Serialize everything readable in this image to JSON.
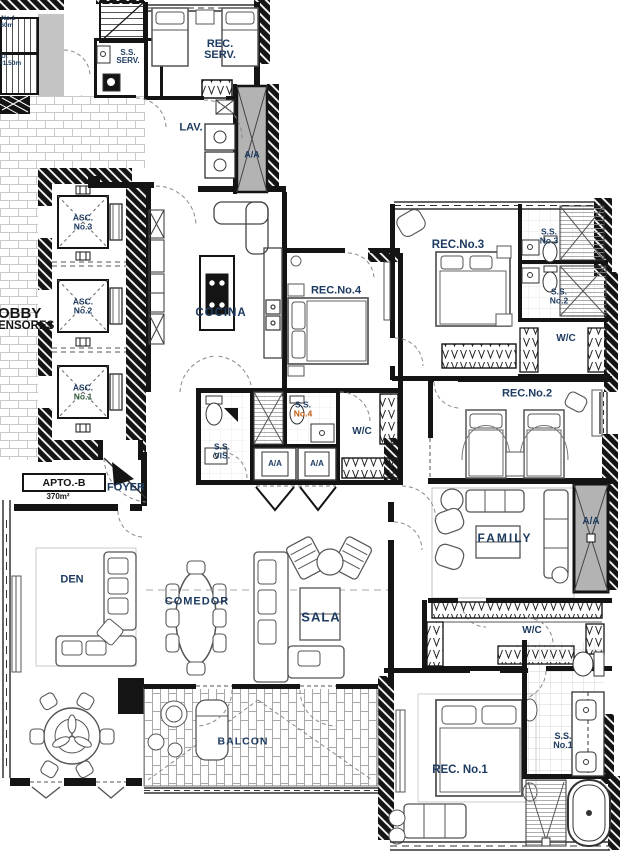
{
  "document": {
    "type": "architectural floor plan",
    "unit_tag": "APTO.-B",
    "unit_area": "370m²"
  },
  "labels": {
    "stairs": {
      "a1": "A No.1",
      "a2": "3.60m",
      "e1": "E.U.",
      "e2": "h=1.50m"
    },
    "service": {
      "ss": "S.S.",
      "serv": "SERV.",
      "rec": "REC.",
      "lav": "LAV."
    },
    "lobby": {
      "l1": "OBBY",
      "l2": "ENSORES"
    },
    "elevators": {
      "asc": "ASC.",
      "no1": "No.1",
      "no2": "No.2",
      "no3": "No.3"
    },
    "entry": {
      "apto": "APTO.-B",
      "area": "370m²",
      "foyer": "FOYER"
    },
    "rooms": {
      "cocina": "COCINA",
      "rec4": "REC.No.4",
      "rec3": "REC.No.3",
      "rec2": "REC.No.2",
      "rec1": "REC. No.1",
      "family": "FAMILY",
      "sala": "SALA",
      "comedor": "COMEDOR",
      "den": "DEN",
      "balcon": "BALCON"
    },
    "baths": {
      "ss": "S.S.",
      "vis": "VIS.",
      "no1": "No.1",
      "no2": "No.2",
      "no3": "No.3",
      "no4": "No.4",
      "wc": "W/C",
      "aa": "A/A"
    }
  },
  "colors": {
    "label_navy": "#1d3b60",
    "text_black": "#141414",
    "accent_orange": "#c05a11",
    "accent_green": "#2f5d3a",
    "wall_black": "#141414",
    "shaft_gray": "#b3b3b3",
    "tile_line": "#cfcfcf"
  }
}
